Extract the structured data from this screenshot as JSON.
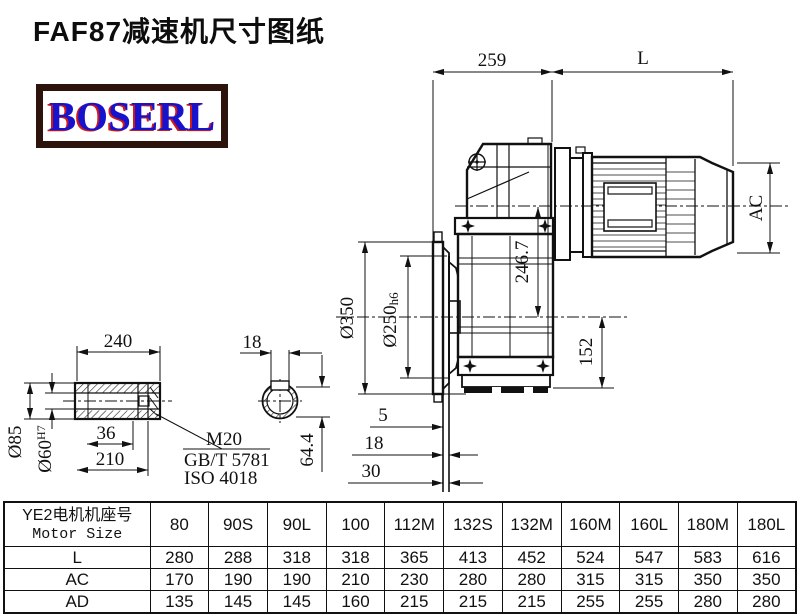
{
  "title": "FAF87减速机尺寸图纸",
  "logo": {
    "text": "BOSERL",
    "text_color": "#1713cd",
    "shadow_color": "#d01818",
    "border_color": "#2d130c"
  },
  "drawing": {
    "dim_259": "259",
    "dim_L": "L",
    "dim_AC": "AC",
    "dim_246_7": "246.7",
    "dim_152": "152",
    "flange_od": "Ø350",
    "spigot_dia": "Ø250",
    "spigot_tol": "h6",
    "dim_5": "5",
    "dim_18": "18",
    "dim_30": "30"
  },
  "shaft_detail": {
    "dim_240": "240",
    "od": "Ø85",
    "bore_dia": "Ø60",
    "bore_tol": "H7",
    "dim_36": "36",
    "dim_210": "210",
    "bolt": "M20",
    "std_gb": "GB/T 5781",
    "std_iso": "ISO 4018",
    "key_width": "18",
    "key_depth": "64.4"
  },
  "table": {
    "head_cn": "YE2电机机座号",
    "head_en": "Motor Size",
    "columns": [
      "80",
      "90S",
      "90L",
      "100",
      "112M",
      "132S",
      "132M",
      "160M",
      "160L",
      "180M",
      "180L"
    ],
    "rows": [
      {
        "label": "L",
        "values": [
          "280",
          "288",
          "318",
          "318",
          "365",
          "413",
          "452",
          "524",
          "547",
          "583",
          "616"
        ]
      },
      {
        "label": "AC",
        "values": [
          "170",
          "190",
          "190",
          "210",
          "230",
          "280",
          "280",
          "315",
          "315",
          "350",
          "350"
        ]
      },
      {
        "label": "AD",
        "values": [
          "135",
          "145",
          "145",
          "160",
          "215",
          "215",
          "215",
          "255",
          "255",
          "280",
          "280"
        ]
      }
    ]
  }
}
